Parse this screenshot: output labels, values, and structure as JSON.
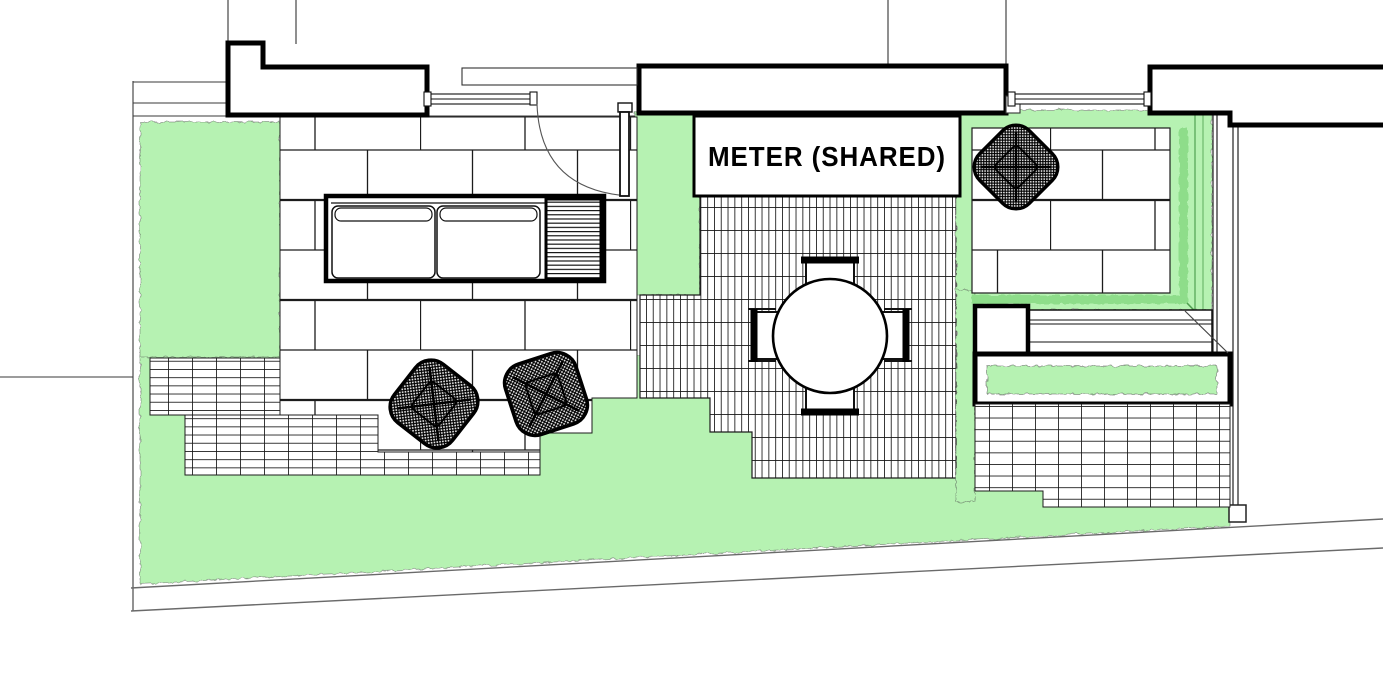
{
  "plan": {
    "meter_label": "METER (SHARED)",
    "colors": {
      "lawn": "#b6f2b2",
      "lawn_shadow": "#8edd8a",
      "hedge_line": "#5fae5f",
      "ink": "#000000",
      "boundary_gray": "#6a6a6a",
      "paper": "#ffffff"
    },
    "regions": [
      "left-lawn",
      "bottom-lawn",
      "central-lawn-strip",
      "large-paver-patio",
      "ceramic-tile-patio",
      "grid-paving-left",
      "grid-paving-bottom",
      "grid-paving-right",
      "raised-patio-right",
      "planter-bed"
    ],
    "furniture": [
      "outdoor-sofa",
      "slatted-side-table",
      "lounge-chair",
      "lounge-chair",
      "lounge-chair",
      "round-dining-table",
      "dining-chair-north",
      "dining-chair-south",
      "dining-chair-east",
      "dining-chair-west",
      "bench",
      "storage-box",
      "planter-box"
    ]
  }
}
